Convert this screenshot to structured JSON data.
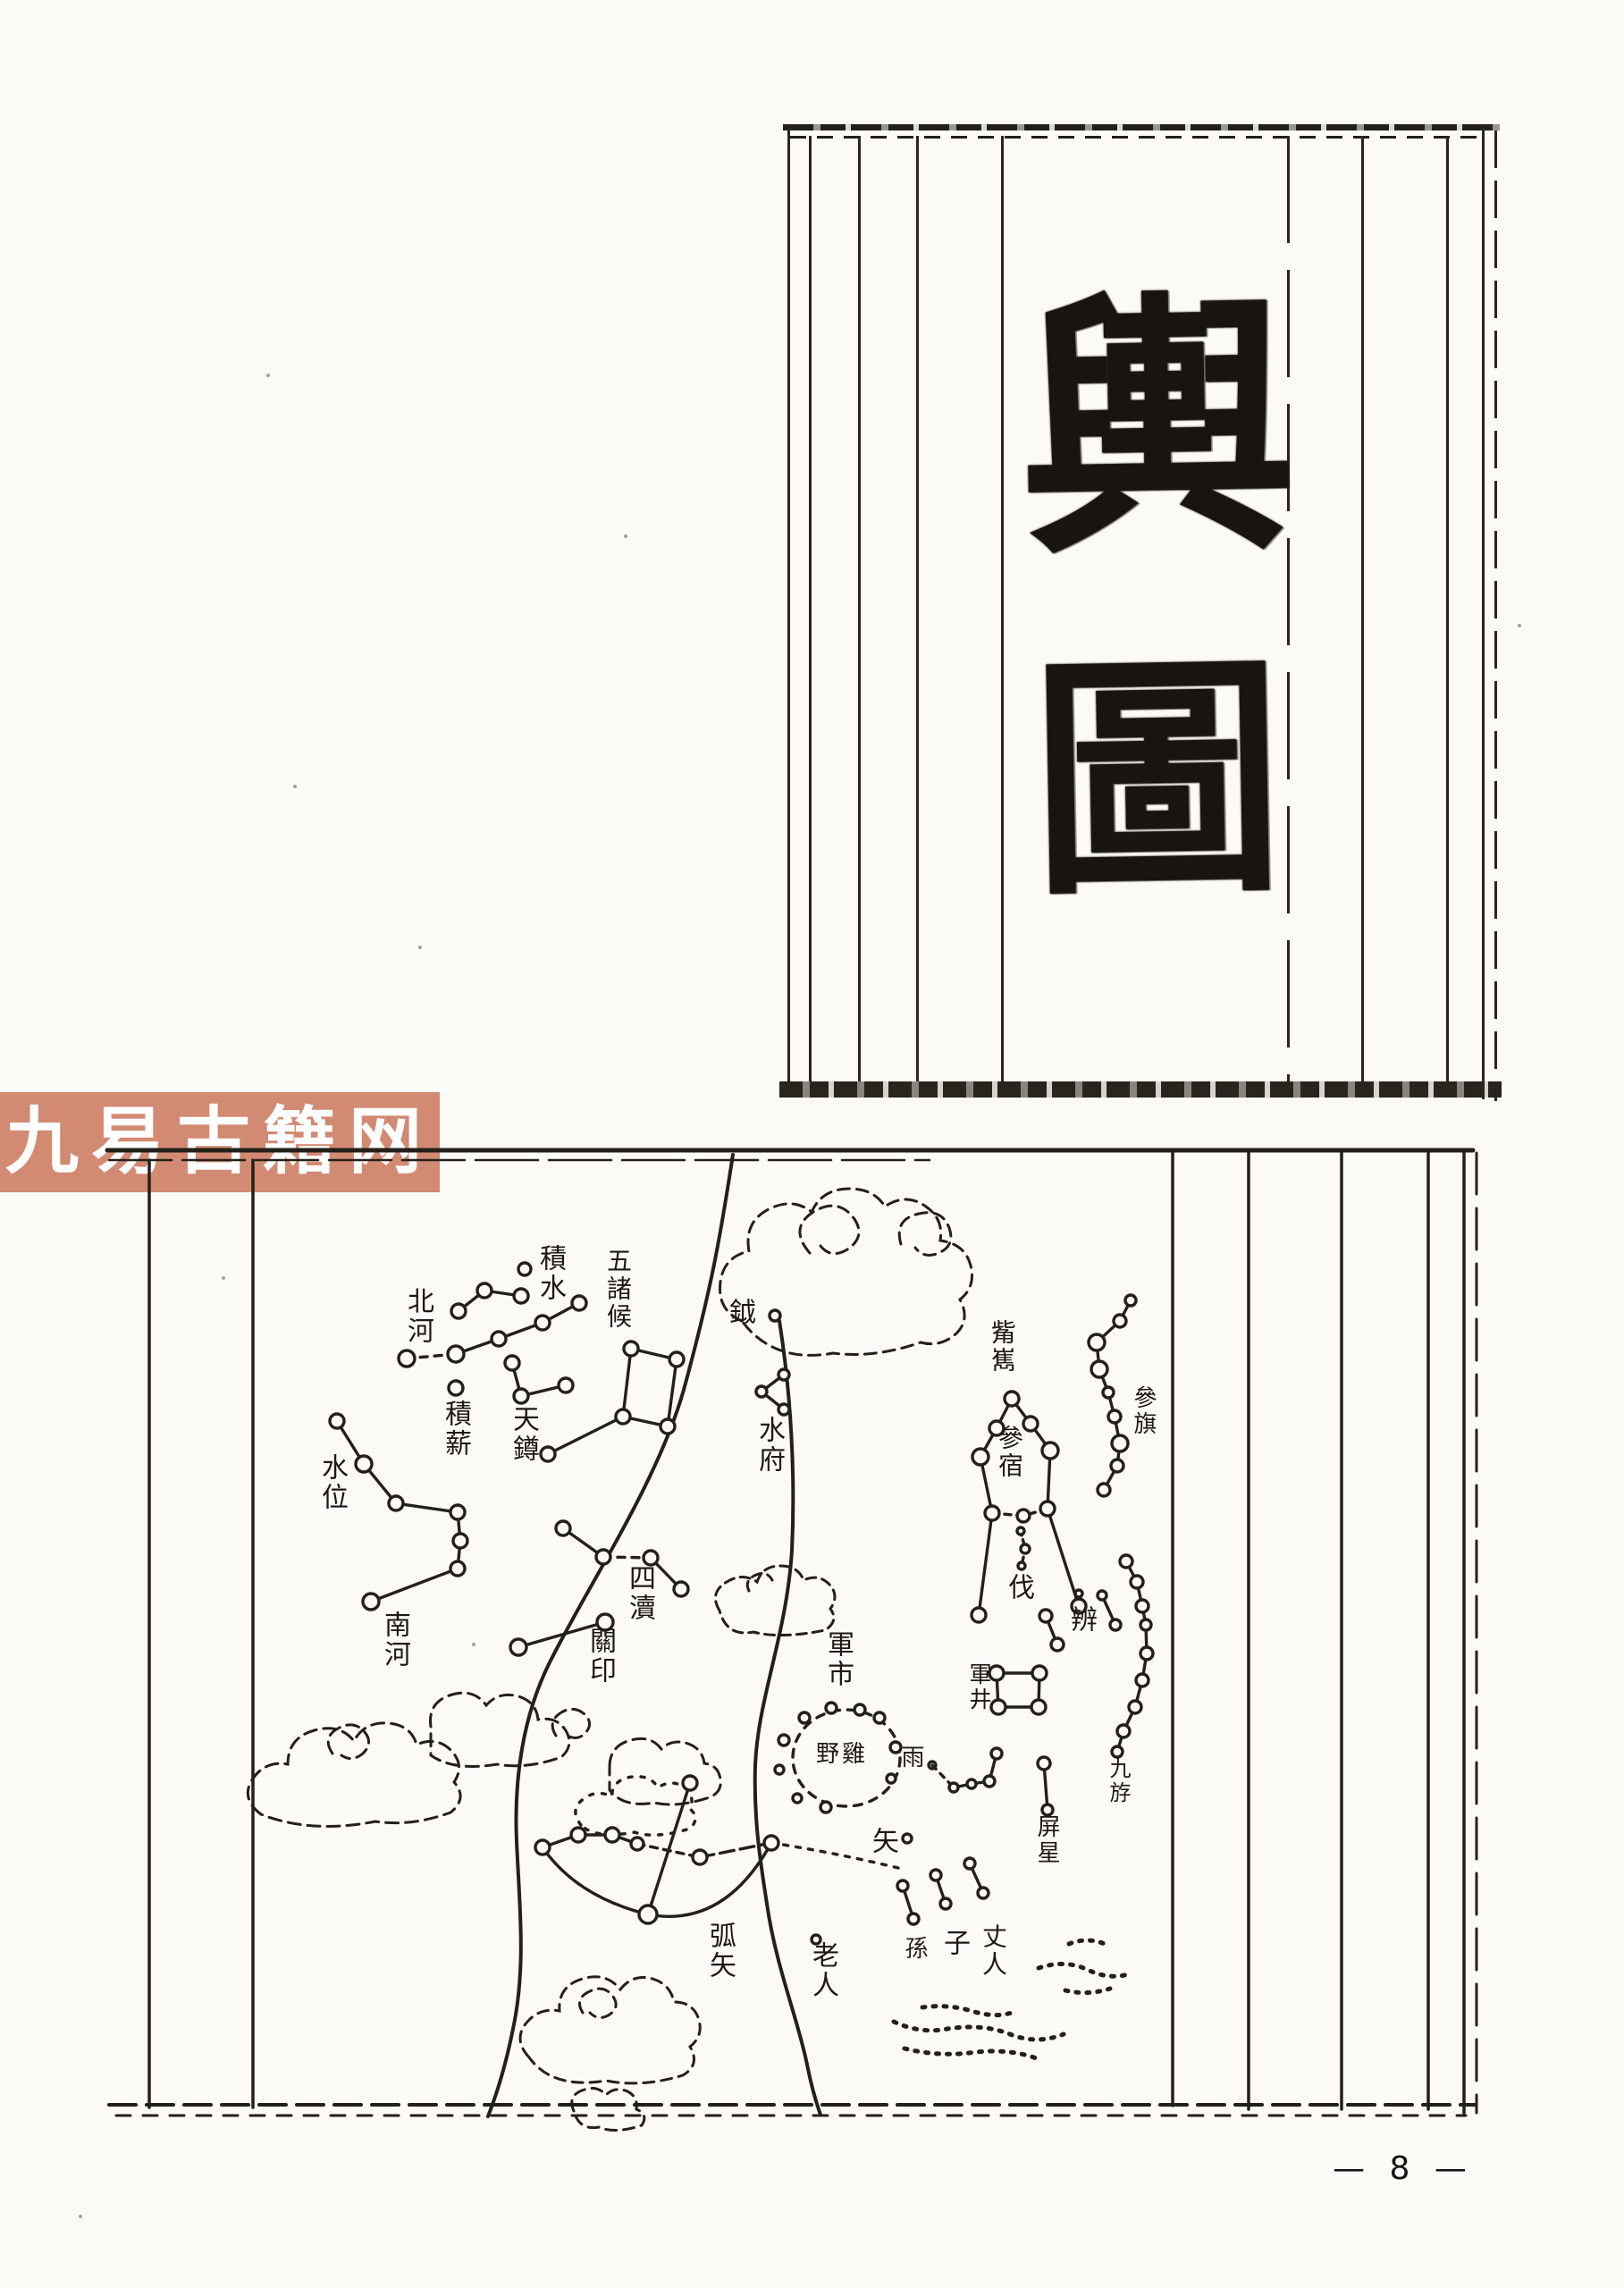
{
  "page": {
    "number_text": "— 8 —",
    "ink": "#242019",
    "paper": "#fbfaf7"
  },
  "title_panel": {
    "char_top": "輿",
    "char_bottom": "圖"
  },
  "watermark": {
    "text": "九易古籍网",
    "background": "#d28a72",
    "color": "#ffffff"
  },
  "chart": {
    "labels": {
      "jishui": "積水",
      "wuzhuhou": "五諸候",
      "beihe": "北河",
      "jixin": "積薪",
      "tianzun": "天鐏",
      "shuiwei": "水位",
      "nanhe": "南河",
      "yue": "鉞",
      "shuifu": "水府",
      "sidu": "四瀆",
      "guanyin": "關印",
      "junshi": "軍市",
      "yeji": "野雞",
      "yu": "雨",
      "junjing": "軍井",
      "zixi": "觜嶲",
      "shenxiu": "參宿",
      "shenqi": "參旗",
      "fa": "伐",
      "bian": "辨",
      "jiuyou": "九斿",
      "pingxing": "屏星",
      "shi": "矢",
      "sun": "孫",
      "zi": "子",
      "zhangren": "丈人",
      "hushi": "弧矢",
      "laoren": "老人"
    }
  }
}
